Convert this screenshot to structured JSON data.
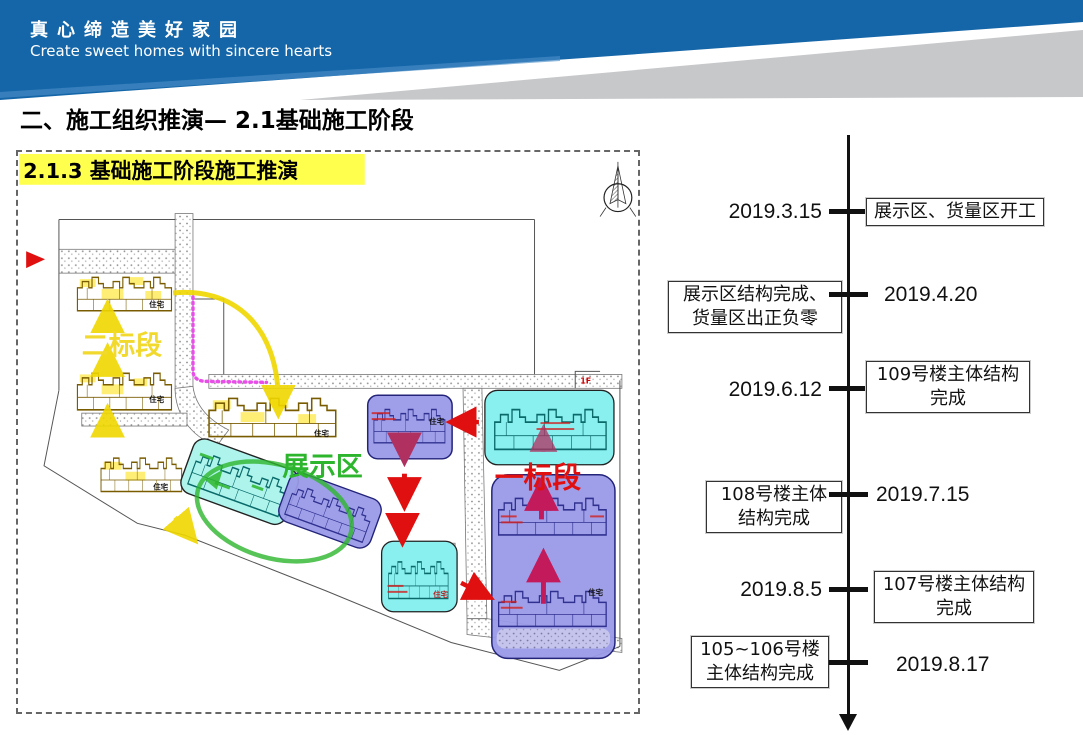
{
  "header": {
    "title_cn": "真心缔造美好家园",
    "title_en": "Create sweet homes with sincere hearts",
    "bg_color": "#1566a8",
    "swoosh_color": "#c7c8ca"
  },
  "page": {
    "title": "二、施工组织推演— 2.1基础施工阶段"
  },
  "plan": {
    "heading": "2.1.3 基础施工阶段施工推演",
    "highlight_color": "#ffff4d",
    "labels": {
      "section_two": "二标段",
      "exhibition_area": "展示区",
      "section_one": "一标段",
      "residence": "住宅",
      "floor": "1F"
    },
    "colors": {
      "yellow": "#f0d800",
      "cyan": "#8aefef",
      "purple": "#9a9ae8",
      "green": "#2db52d",
      "red": "#e01010",
      "magenta": "#e84fe8",
      "crimson": "#c21a5a"
    }
  },
  "timeline": {
    "events": [
      {
        "date": "2019.3.15",
        "label": "展示区、货量区开工",
        "label_line2": ""
      },
      {
        "date": "2019.4.20",
        "label": "展示区结构完成、",
        "label_line2": "货量区出正负零"
      },
      {
        "date": "2019.6.12",
        "label": "109号楼主体结构",
        "label_line2": "完成"
      },
      {
        "date": "2019.7.15",
        "label": "108号楼主体",
        "label_line2": "结构完成"
      },
      {
        "date": "2019.8.5",
        "label": "107号楼主体结构",
        "label_line2": "完成"
      },
      {
        "date": "2019.8.17",
        "label": "105~106号楼",
        "label_line2": "主体结构完成"
      }
    ]
  }
}
